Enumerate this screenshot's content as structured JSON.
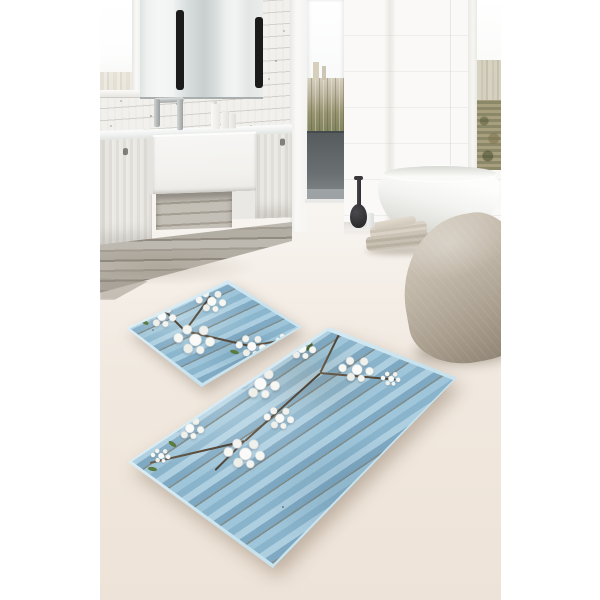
{
  "scene": {
    "kind": "product photograph",
    "subject": "two-piece bath mat set displayed on a bathroom floor",
    "setting": "modern bathroom with white shiplap wood wall, floating light-wood vanity, mirror, balcony door and freestanding bathtub",
    "page_background_color": "#ffffff",
    "photo_floor_color": "#f1e8df"
  },
  "bathroom": {
    "wall": {
      "style": "white horizontal wood planks",
      "color": "#f2f0ed"
    },
    "mirror": {
      "description": "large frameless mirror with two vertical black strip lamps",
      "lamp_color": "#1b1b1c"
    },
    "left_window": {
      "description": "bright window with faint city skyline"
    },
    "balcony_door": {
      "description": "floor-to-ceiling opening with city view and dark balustrade panel",
      "railing_color": "#5c6164"
    },
    "far_window": {
      "description": "narrow window with dense cityscape and high-rise towers"
    },
    "vanity": {
      "counter_color": "#eef0ef",
      "sink": "white farmhouse-style rectangular sink",
      "cabinets": "light greige wood with small dark handles",
      "base": "weathered grey wood plank plinth",
      "faucet": "chrome bridge faucet",
      "toiletries": "three white bottles on counter"
    },
    "bathtub": {
      "description": "white freestanding oval tub",
      "color": "#f7f7f5"
    },
    "accessories": {
      "vase": {
        "description": "dark teardrop floor vase",
        "color": "#37373a"
      },
      "bottle": "small white bottle beside vase",
      "towels": "stack of folded beige towels",
      "pouf": {
        "description": "large stone-shaped beige pouf",
        "color": "#b4aa9b"
      }
    }
  },
  "product": {
    "set_count": 2,
    "mats": [
      {
        "id": "small-mat",
        "shape": "rounded rectangle, laid diagonally",
        "print": "light blue wooden planks with white cherry blossom branch"
      },
      {
        "id": "large-mat",
        "shape": "rounded rectangle, laid diagonally",
        "print": "light blue wooden planks with white cherry blossom branches"
      }
    ],
    "print_colors": {
      "plank_blue": "#8fb9cf",
      "plank_blue_light": "#aecfe0",
      "plank_seam": "#6b5f4c",
      "blossom_white": "#f6f6f3",
      "leaf_green": "#5b7a3e",
      "branch_brown": "#5a4c3d",
      "edge_binding": "#cfe8f2"
    }
  }
}
